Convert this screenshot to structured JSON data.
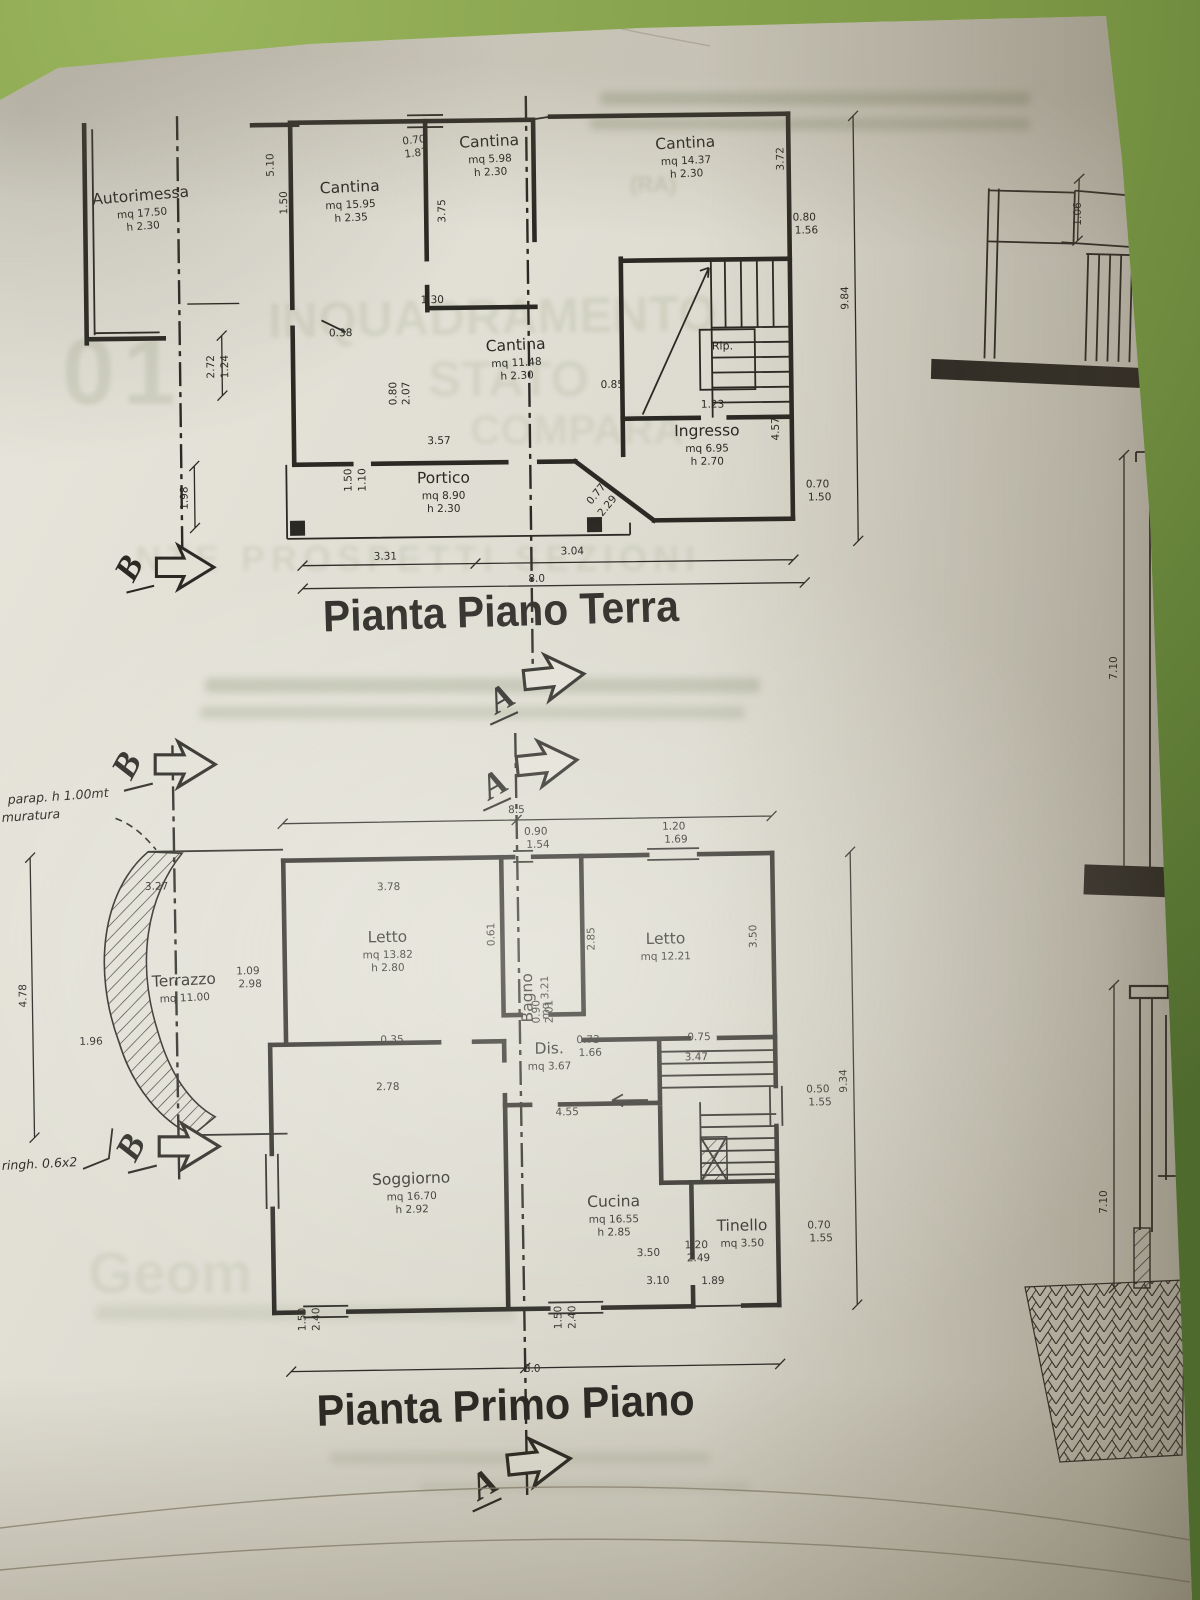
{
  "colors": {
    "ink": "#2b2924",
    "paper": "#e0ded3",
    "background_green": "#88a44e"
  },
  "markers": {
    "a": "A",
    "b": "B"
  },
  "ground_floor": {
    "title": "Pianta Piano Terra",
    "rooms": [
      {
        "id": "autorimessa",
        "name": "Autorimessa",
        "line2": "mq 17.50",
        "line3": "h 2.30"
      },
      {
        "id": "cantina-left",
        "name": "Cantina",
        "line2": "mq 15.95",
        "line3": "h 2.35"
      },
      {
        "id": "cantina-top",
        "name": "Cantina",
        "line2": "mq 5.98",
        "line3": "h 2.30"
      },
      {
        "id": "cantina-right",
        "name": "Cantina",
        "line2": "mq 14.37",
        "line3": "h 2.30"
      },
      {
        "id": "cantina-center",
        "name": "Cantina",
        "line2": "mq 11.48",
        "line3": "h 2.30"
      },
      {
        "id": "ingresso",
        "name": "Ingresso",
        "line2": "mq 6.95",
        "line3": "h 2.70"
      },
      {
        "id": "portico",
        "name": "Portico",
        "line2": "mq 8.90",
        "line3": "h 2.30"
      },
      {
        "id": "rip",
        "name": "Rip.",
        "line2": "",
        "line3": ""
      }
    ],
    "dims": [
      {
        "t": "0.70",
        "x": 417,
        "y": 142,
        "r": -6
      },
      {
        "t": "1.87",
        "x": 419,
        "y": 155,
        "r": -6
      },
      {
        "t": "5.10",
        "x": 276,
        "y": 162,
        "r": -90
      },
      {
        "t": "1.50",
        "x": 289,
        "y": 200,
        "r": -90
      },
      {
        "t": "3.75",
        "x": 447,
        "y": 210,
        "r": -90
      },
      {
        "t": "3.72",
        "x": 786,
        "y": 162,
        "r": -90
      },
      {
        "t": "0.80",
        "x": 806,
        "y": 224,
        "r": 0
      },
      {
        "t": "1.56",
        "x": 808,
        "y": 237,
        "r": 0
      },
      {
        "t": "1.30",
        "x": 433,
        "y": 302,
        "r": 0
      },
      {
        "t": "0.38",
        "x": 341,
        "y": 334,
        "r": 0
      },
      {
        "t": "2.72",
        "x": 214,
        "y": 363,
        "r": -90
      },
      {
        "t": "1.24",
        "x": 228,
        "y": 363,
        "r": -90
      },
      {
        "t": "0.80",
        "x": 396,
        "y": 392,
        "r": -90
      },
      {
        "t": "2.07",
        "x": 409,
        "y": 392,
        "r": -90
      },
      {
        "t": "0.85",
        "x": 612,
        "y": 389,
        "r": 0
      },
      {
        "t": "1.23",
        "x": 712,
        "y": 410,
        "r": 0
      },
      {
        "t": "1.98",
        "x": 186,
        "y": 494,
        "r": -90
      },
      {
        "t": "1.50",
        "x": 350,
        "y": 478,
        "r": -90
      },
      {
        "t": "1.10",
        "x": 364,
        "y": 478,
        "r": -90
      },
      {
        "t": "3.57",
        "x": 438,
        "y": 443,
        "r": 0
      },
      {
        "t": "4.57",
        "x": 778,
        "y": 432,
        "r": -90
      },
      {
        "t": "0.77",
        "x": 597,
        "y": 497,
        "r": -50
      },
      {
        "t": "2.29",
        "x": 608,
        "y": 509,
        "r": -50
      },
      {
        "t": "0.70",
        "x": 816,
        "y": 491,
        "r": 0
      },
      {
        "t": "1.50",
        "x": 818,
        "y": 504,
        "r": 0
      },
      {
        "t": "9.84",
        "x": 849,
        "y": 302,
        "r": -90
      },
      {
        "t": "3.31",
        "x": 383,
        "y": 558,
        "r": 0
      },
      {
        "t": "3.04",
        "x": 570,
        "y": 555,
        "r": 0
      },
      {
        "t": "8.0",
        "x": 534,
        "y": 582,
        "r": 0
      }
    ]
  },
  "first_floor": {
    "title": "Pianta Primo Piano",
    "rooms": [
      {
        "id": "terrazzo",
        "name": "Terrazzo",
        "line2": "mq 11.00",
        "line3": ""
      },
      {
        "id": "letto-left",
        "name": "Letto",
        "line2": "mq 13.82",
        "line3": "h 2.80"
      },
      {
        "id": "bagno",
        "name": "Bagno",
        "line2": "mq 3.21",
        "line3": ""
      },
      {
        "id": "letto-right",
        "name": "Letto",
        "line2": "mq 12.21",
        "line3": ""
      },
      {
        "id": "dis",
        "name": "Dis.",
        "line2": "mq 3.67",
        "line3": ""
      },
      {
        "id": "soggiorno",
        "name": "Soggiorno",
        "line2": "mq 16.70",
        "line3": "h 2.92"
      },
      {
        "id": "cucina",
        "name": "Cucina",
        "line2": "mq 16.55",
        "line3": "h 2.85"
      },
      {
        "id": "tinello",
        "name": "Tinello",
        "line2": "mq 3.50",
        "line3": ""
      }
    ],
    "dims": [
      {
        "t": "8.5",
        "x": 521,
        "y": 813,
        "r": 0
      },
      {
        "t": "0.90",
        "x": 540,
        "y": 835,
        "r": 0
      },
      {
        "t": "1.54",
        "x": 542,
        "y": 848,
        "r": 0
      },
      {
        "t": "1.20",
        "x": 678,
        "y": 832,
        "r": 0
      },
      {
        "t": "1.69",
        "x": 680,
        "y": 845,
        "r": 0
      },
      {
        "t": "3.78",
        "x": 392,
        "y": 888,
        "r": 0
      },
      {
        "t": "0.61",
        "x": 497,
        "y": 934,
        "r": -90
      },
      {
        "t": "2.85",
        "x": 597,
        "y": 940,
        "r": -90
      },
      {
        "t": "3.50",
        "x": 759,
        "y": 940,
        "r": -90
      },
      {
        "t": "0.90",
        "x": 541,
        "y": 1012,
        "r": -90
      },
      {
        "t": "2.01",
        "x": 554,
        "y": 1012,
        "r": -90
      },
      {
        "t": "0.73",
        "x": 589,
        "y": 1044,
        "r": 0
      },
      {
        "t": "1.66",
        "x": 591,
        "y": 1057,
        "r": 0
      },
      {
        "t": "0.75",
        "x": 700,
        "y": 1043,
        "r": 0
      },
      {
        "t": "3.47",
        "x": 697,
        "y": 1063,
        "r": 0
      },
      {
        "t": "0.35",
        "x": 393,
        "y": 1041,
        "r": 0
      },
      {
        "t": "2.78",
        "x": 388,
        "y": 1088,
        "r": 0
      },
      {
        "t": "4.55",
        "x": 567,
        "y": 1116,
        "r": 0
      },
      {
        "t": "0.50",
        "x": 818,
        "y": 1097,
        "r": 0
      },
      {
        "t": "1.55",
        "x": 820,
        "y": 1110,
        "r": 0
      },
      {
        "t": "9.34",
        "x": 847,
        "y": 1086,
        "r": -90
      },
      {
        "t": "1.20",
        "x": 694,
        "y": 1251,
        "r": 0
      },
      {
        "t": "2.49",
        "x": 696,
        "y": 1264,
        "r": 0
      },
      {
        "t": "0.70",
        "x": 817,
        "y": 1233,
        "r": 0
      },
      {
        "t": "1.55",
        "x": 819,
        "y": 1246,
        "r": 0
      },
      {
        "t": "3.50",
        "x": 646,
        "y": 1258,
        "r": 0
      },
      {
        "t": "3.10",
        "x": 655,
        "y": 1286,
        "r": 0
      },
      {
        "t": "1.89",
        "x": 710,
        "y": 1287,
        "r": 0
      },
      {
        "t": "1.50",
        "x": 302,
        "y": 1316,
        "r": -90
      },
      {
        "t": "2.40",
        "x": 316,
        "y": 1316,
        "r": -90
      },
      {
        "t": "1.50",
        "x": 558,
        "y": 1318,
        "r": -90
      },
      {
        "t": "2.40",
        "x": 572,
        "y": 1318,
        "r": -90
      },
      {
        "t": "8.0",
        "x": 528,
        "y": 1372,
        "r": 0
      },
      {
        "t": "4.78",
        "x": 28,
        "y": 988,
        "r": -90
      },
      {
        "t": "1.96",
        "x": 92,
        "y": 1038,
        "r": 0
      },
      {
        "t": "3.27",
        "x": 160,
        "y": 884,
        "r": 0
      },
      {
        "t": "1.09",
        "x": 250,
        "y": 970,
        "r": 0
      },
      {
        "t": "2.98",
        "x": 252,
        "y": 983,
        "r": 0
      }
    ]
  },
  "sections": {
    "dims": [
      {
        "t": "1.06",
        "x": 1081,
        "y": 214,
        "r": -90
      },
      {
        "t": "7.10",
        "x": 1117,
        "y": 668,
        "r": -90
      },
      {
        "t": "7.10",
        "x": 1107,
        "y": 1202,
        "r": -90
      }
    ]
  },
  "notes": {
    "terrace_top_1": "parap. h 1.00mt",
    "terrace_top_2": "muratura",
    "terrace_bottom": "ringh. 0.6x2"
  },
  "ghost_text": {
    "g1": "01",
    "g2": "INQUADRAMENTO",
    "g3": "STATO",
    "g4": "COMPARA",
    "g5": "NTE PROSPETTI SEZIONI",
    "g6": "(RA)",
    "g7": "Geom"
  }
}
